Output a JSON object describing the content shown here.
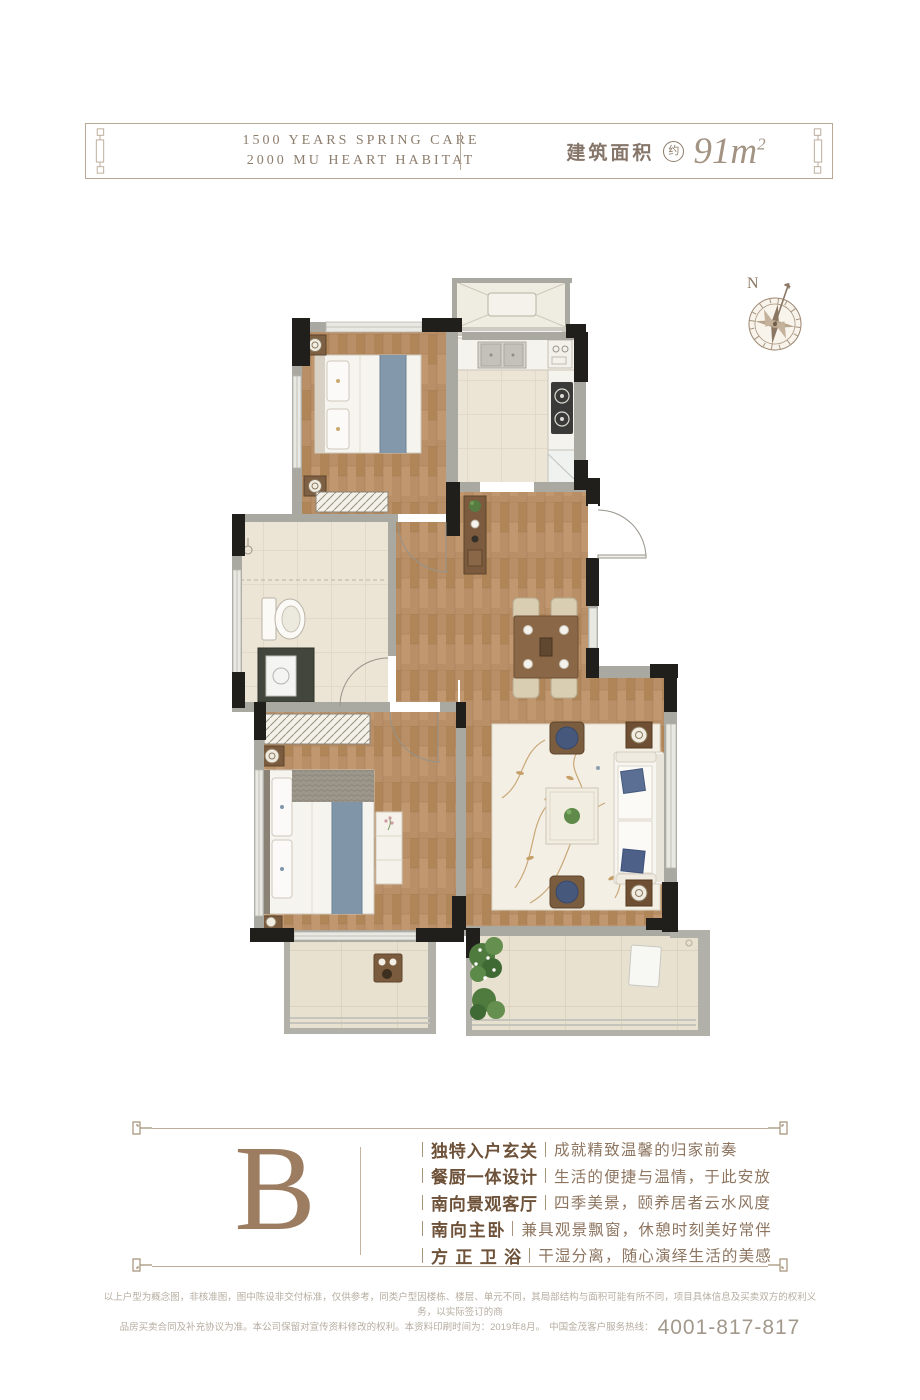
{
  "header": {
    "line1": "1500 YEARS SPRING CARE",
    "line2": "2000 MU HEART HABITAT",
    "area_label": "建筑面积",
    "area_badge": "约",
    "area_value": "91m",
    "area_sup": "2"
  },
  "compass": {
    "label": "N"
  },
  "unit": {
    "letter": "B"
  },
  "features": {
    "items": [
      {
        "label": "独特入户玄关",
        "desc": "成就精致温馨的归家前奏"
      },
      {
        "label": "餐厨一体设计",
        "desc": "生活的便捷与温情，于此安放"
      },
      {
        "label": "南向景观客厅",
        "desc": "四季美景，颐养居者云水风度"
      },
      {
        "label": "南向主卧",
        "desc": "兼具观景飘窗，休憩时刻美好常伴"
      },
      {
        "label": "方正卫浴",
        "desc": "干湿分离，随心演绎生活的美感"
      }
    ]
  },
  "footer": {
    "disclaimer_line1": "以上户型为概念图，非核准图，图中陈设非交付标准，仅供参考，同类户型因楼栋、楼层、单元不同，其局部结构与面积可能有所不同，项目具体信息及买卖双方的权利义务，以实际签订的商",
    "disclaimer_line2": "品房买卖合同及补充协议为准。本公司保留对宣传资料修改的权利。本资料印刷时间为：2019年8月。",
    "hotline_label": "中国金茂客户服务热线：",
    "hotline_number": "4001-817-817"
  },
  "floor_plan": {
    "rooms": [
      "second-bedroom",
      "kitchen",
      "equipment-platform",
      "entry",
      "dining-area",
      "hallway",
      "bathroom",
      "master-bedroom",
      "living-room",
      "balcony-south-left",
      "balcony-south-right"
    ],
    "colors": {
      "wall_black": "#211f1c",
      "wall_gray": "#a9a8a1",
      "window_light": "#e9e9e3",
      "wood_floor": "#b88f67",
      "tile_floor": "#ece5d6",
      "balcony_tile": "#e9e1cf",
      "fabric_blue": "#8095a8",
      "furniture_white": "#f6f4ef",
      "furniture_brown": "#7a5b3d",
      "plant_green": "#4f7b3f",
      "rug_cream": "#f3efe4",
      "accent_brown": "#9c7d61",
      "frame_line": "#bdac9a"
    }
  }
}
